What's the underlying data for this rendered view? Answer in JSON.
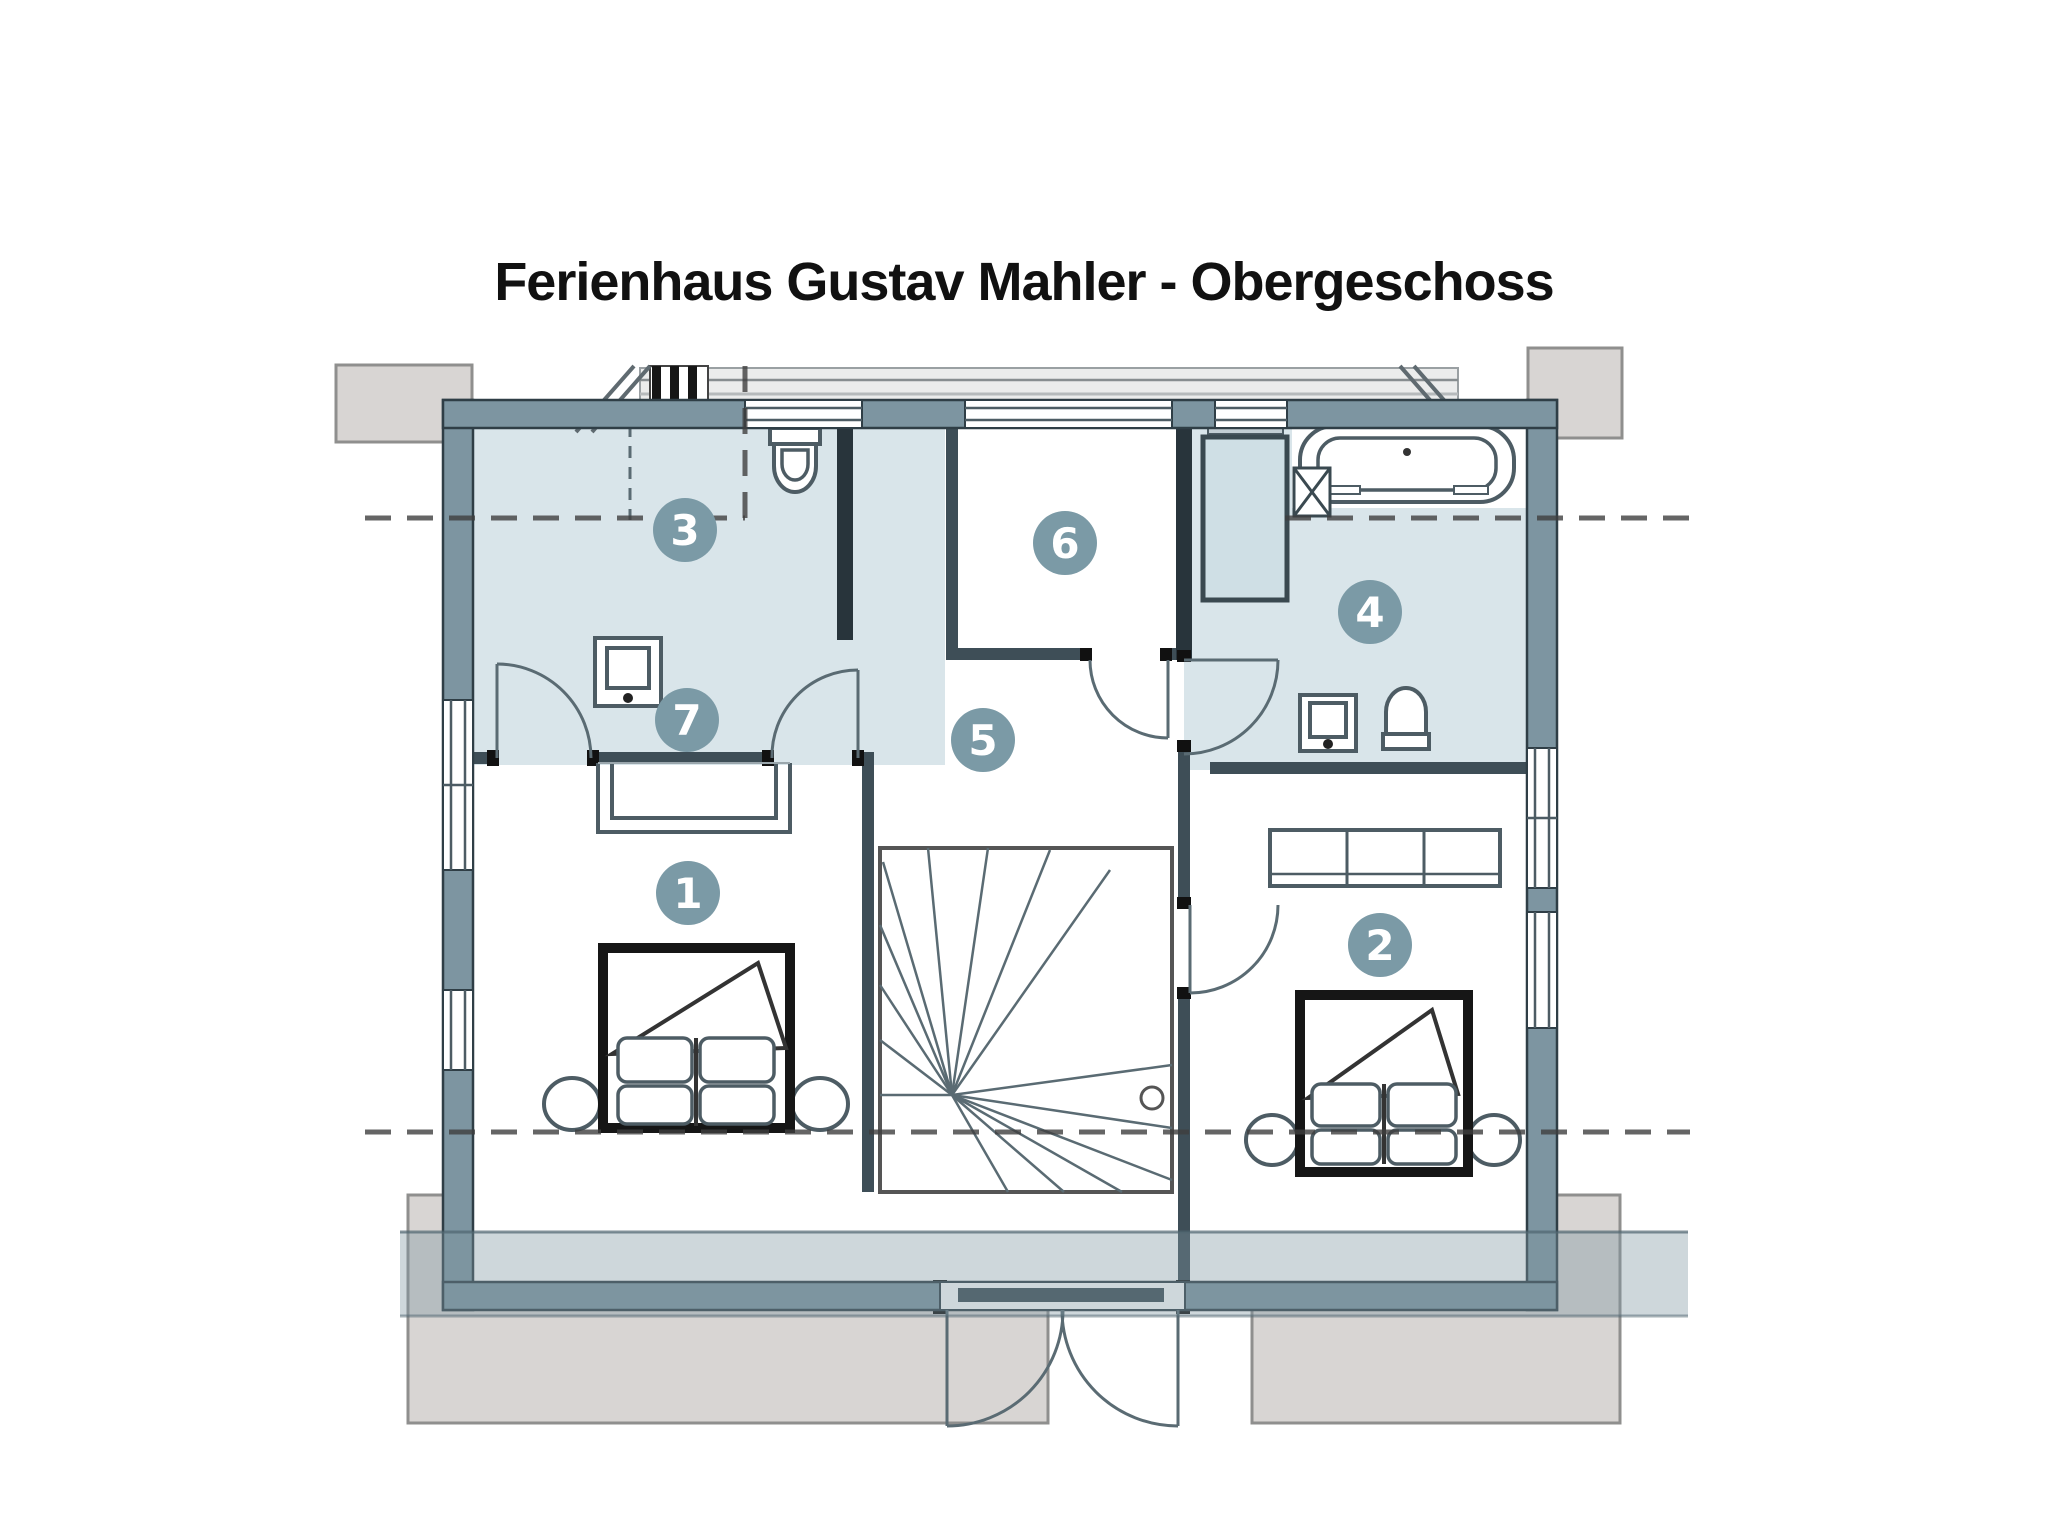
{
  "title": "Ferienhaus Gustav Mahler - Obergeschoss",
  "rooms": [
    {
      "number": "1",
      "marker": "room-1"
    },
    {
      "number": "2",
      "marker": "room-2"
    },
    {
      "number": "3",
      "marker": "room-3"
    },
    {
      "number": "4",
      "marker": "room-4"
    },
    {
      "number": "5",
      "marker": "room-5"
    },
    {
      "number": "6",
      "marker": "room-6"
    },
    {
      "number": "7",
      "marker": "room-7"
    }
  ],
  "icons": {
    "fixtures": [
      "bed-icon",
      "bathtub-icon",
      "shower-icon",
      "toilet-icon",
      "sink-icon",
      "wardrobe-icon",
      "desk-icon",
      "stairs-icon",
      "door-swing-icon",
      "window-icon",
      "chimney-icon"
    ]
  },
  "colors": {
    "wall": "#7d95a1",
    "bathroom_fill": "#d9e5ea",
    "marker_fill": "#7b9aa6",
    "terrace_fill": "#d6d3d1",
    "roof_overlay": "rgba(125,149,161,0.38)",
    "title_text": "#111111"
  }
}
